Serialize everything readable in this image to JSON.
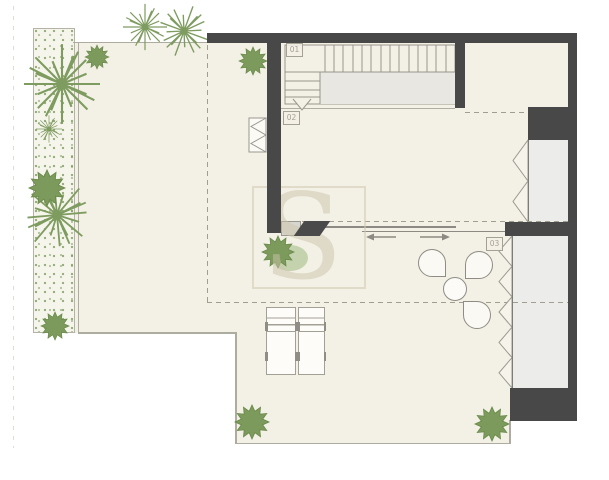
{
  "plan": {
    "title": "floor-plan",
    "labels": {
      "stairs": "01",
      "hall": "02",
      "lounge": "03"
    },
    "watermark": {
      "letter": "S"
    },
    "colors": {
      "wall": "#484848",
      "floor": "#f3f0e5",
      "planted_green": "#7d9b5e",
      "wardrobe": "#ececea",
      "outline": "#aeaca1"
    }
  }
}
